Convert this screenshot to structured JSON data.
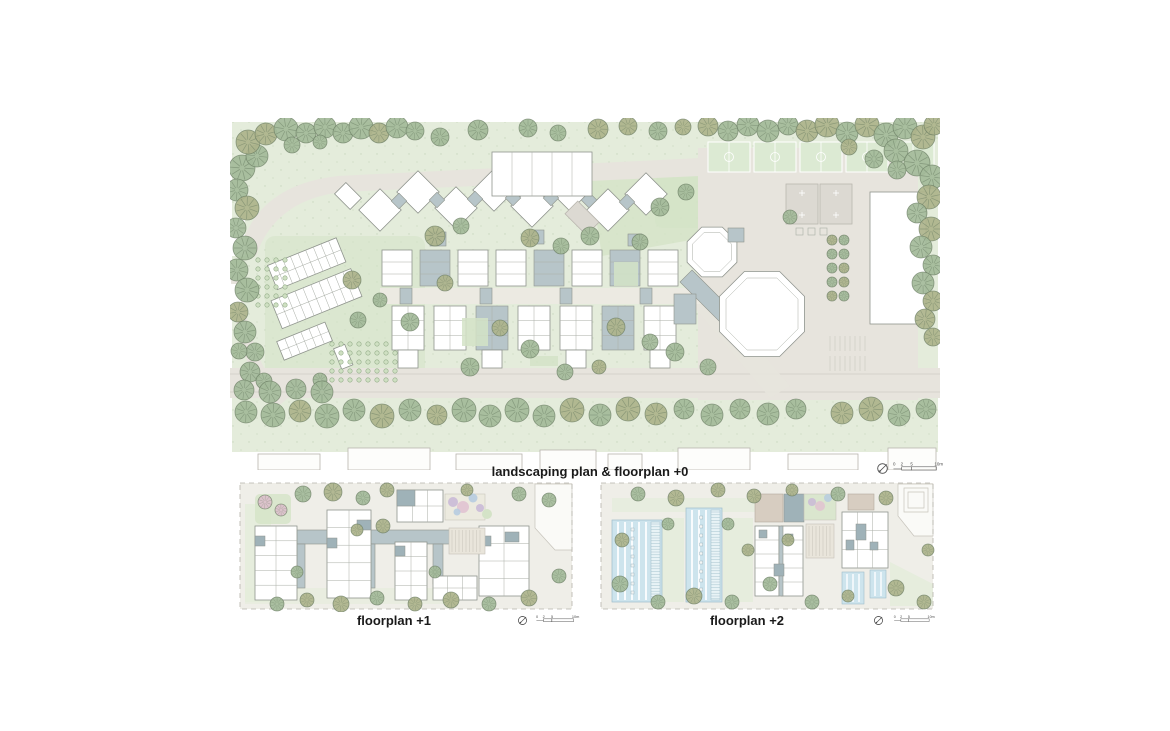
{
  "page": {
    "background": "#ffffff"
  },
  "palette": {
    "landscape_green": "#e4ecdb",
    "lawn_green": "#d4e3c7",
    "tree_green": "#a3ba99",
    "tree_olive": "#adb38b",
    "tree_outline": "#66795f",
    "paving": "#e7e4dd",
    "building_white": "#ffffff",
    "building_outline": "#8f948d",
    "building_slate": "#b7c5c9",
    "slate_dark": "#9fb2b8",
    "solar_blue": "#cde4ed",
    "roof_beige": "#d7cdc1",
    "play_purple": "#c8b7d7",
    "play_pink": "#e1c1d1",
    "play_blue": "#b4cae1",
    "pitch_green": "#dcead3",
    "court_gray": "#dcd9d2",
    "text_black": "#1a1a1a"
  },
  "panels": {
    "main": {
      "caption": "landscaping plan & floorplan +0",
      "scale_labels": [
        "0",
        "2",
        "5",
        "10m"
      ]
    },
    "plus1": {
      "caption": "floorplan +1",
      "scale_labels": [
        "0",
        "2",
        "5",
        "10m"
      ]
    },
    "plus2": {
      "caption": "floorplan +2",
      "scale_labels": [
        "0",
        "2",
        "5",
        "10m"
      ]
    }
  }
}
